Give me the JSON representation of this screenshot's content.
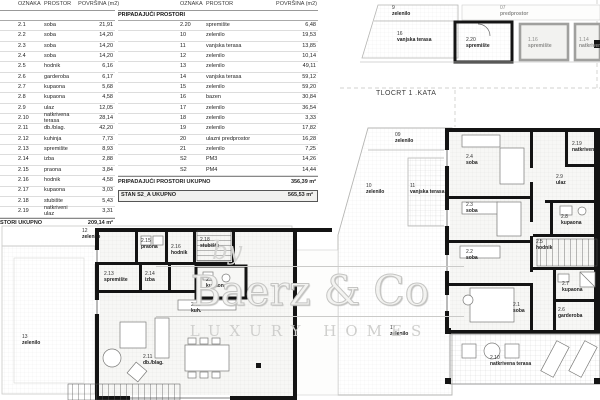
{
  "tables": {
    "headers": {
      "oznaka": "OZNAKA",
      "prostor": "PROSTOR",
      "povrsina": "POVRŠINA (m2)"
    },
    "left": {
      "section": "TORI",
      "rows": [
        {
          "o": "2.1",
          "p": "soba",
          "a": "21,91"
        },
        {
          "o": "2.2",
          "p": "soba",
          "a": "14,20"
        },
        {
          "o": "2.3",
          "p": "soba",
          "a": "14,20"
        },
        {
          "o": "2.4",
          "p": "soba",
          "a": "14,20"
        },
        {
          "o": "2.5",
          "p": "hodnik",
          "a": "6,16"
        },
        {
          "o": "2.6",
          "p": "garderoba",
          "a": "6,17"
        },
        {
          "o": "2.7",
          "p": "kupaona",
          "a": "5,68"
        },
        {
          "o": "2.8",
          "p": "kupaona",
          "a": "4,58"
        },
        {
          "o": "2.9",
          "p": "ulaz",
          "a": "12,05"
        },
        {
          "o": "2.10",
          "p": "natkrivena terasa",
          "a": "28,14"
        },
        {
          "o": "2.11",
          "p": "db./blag.",
          "a": "42,20"
        },
        {
          "o": "2.12",
          "p": "kuhinja",
          "a": "7,73"
        },
        {
          "o": "2.13",
          "p": "spremište",
          "a": "8,93"
        },
        {
          "o": "2.14",
          "p": "izba",
          "a": "2,88"
        },
        {
          "o": "2.15",
          "p": "praona",
          "a": "3,84"
        },
        {
          "o": "2.16",
          "p": "hodnik",
          "a": "4,58"
        },
        {
          "o": "2.17",
          "p": "kupaona",
          "a": "3,03"
        },
        {
          "o": "2.18",
          "p": "stubište",
          "a": "5,43"
        },
        {
          "o": "2.19",
          "p": "natkriveni ulaz",
          "a": "3,31"
        }
      ],
      "footer": {
        "label": "STORI UKUPNO",
        "value": "209,14 m²"
      }
    },
    "right": {
      "section": "PRIPADAJUĆI PROSTORI",
      "rows": [
        {
          "o": "2.20",
          "p": "spremište",
          "a": "6,48"
        },
        {
          "o": "10",
          "p": "zelenilo",
          "a": "19,53"
        },
        {
          "o": "11",
          "p": "vanjska terasa",
          "a": "13,85"
        },
        {
          "o": "12",
          "p": "zelenilo",
          "a": "10,14"
        },
        {
          "o": "13",
          "p": "zelenilo",
          "a": "49,11"
        },
        {
          "o": "14",
          "p": "vanjska terasa",
          "a": "59,12"
        },
        {
          "o": "15",
          "p": "zelenilo",
          "a": "59,20"
        },
        {
          "o": "16",
          "p": "bazen",
          "a": "30,84"
        },
        {
          "o": "17",
          "p": "zelenilo",
          "a": "36,54"
        },
        {
          "o": "18",
          "p": "zelenilo",
          "a": "3,33"
        },
        {
          "o": "19",
          "p": "zelenilo",
          "a": "17,82"
        },
        {
          "o": "20",
          "p": "ulazni predprostor",
          "a": "16,28"
        },
        {
          "o": "21",
          "p": "zelenilo",
          "a": "7,25"
        },
        {
          "o": "S2",
          "p": "PM3",
          "a": "14,26"
        },
        {
          "o": "S2",
          "p": "PM4",
          "a": "14,44"
        }
      ],
      "footer": {
        "label": "PRIPADAJUĆI PROSTORI UKUPNO",
        "value": "356,39 m²"
      },
      "total": {
        "label": "STAN S2_A UKUPNO",
        "value": "565,53 m²"
      }
    }
  },
  "plan": {
    "title": "TLOCRT 1 .KATA",
    "right_rooms": [
      {
        "id": "2.4",
        "name": "soba"
      },
      {
        "id": "2.3",
        "name": "soba"
      },
      {
        "id": "2.2",
        "name": "soba"
      },
      {
        "id": "2.1",
        "name": "soba"
      },
      {
        "id": "2.5",
        "name": "hodnik"
      },
      {
        "id": "2.6",
        "name": "garderoba"
      },
      {
        "id": "2.7",
        "name": "kupaona"
      },
      {
        "id": "2.8",
        "name": "kupaona"
      },
      {
        "id": "2.9",
        "name": "ulaz"
      },
      {
        "id": "2.19",
        "name": "natkriveni"
      },
      {
        "id": "2.10",
        "name": "natkrivena terasa"
      }
    ],
    "right_outdoor": [
      {
        "id": "09",
        "name": "zelenilo"
      },
      {
        "id": "10",
        "name": "zelenilo"
      },
      {
        "id": "11",
        "name": "vanjska terasa"
      },
      {
        "id": "17",
        "name": "zelenilo"
      }
    ],
    "top_fragment": [
      {
        "id": "9",
        "name": "zelenilo"
      },
      {
        "id": "07",
        "name": "predprostor"
      },
      {
        "id": "16",
        "name": "vanjska terasa"
      },
      {
        "id": "2.20",
        "name": "spremište"
      },
      {
        "id": "1.16",
        "name": "spremište"
      },
      {
        "id": "1.14",
        "name": "natkriveni"
      }
    ],
    "left_rooms": [
      {
        "id": "2.15",
        "name": "praona"
      },
      {
        "id": "2.16",
        "name": "hodnik"
      },
      {
        "id": "2.18",
        "name": "stubište"
      },
      {
        "id": "2.13",
        "name": "spremište"
      },
      {
        "id": "2.14",
        "name": "izba"
      },
      {
        "id": "2.17",
        "name": "kupaona"
      },
      {
        "id": "2.12",
        "name": "kuh."
      },
      {
        "id": "2.11",
        "name": "db./blag."
      }
    ],
    "left_outdoor": [
      {
        "id": "12",
        "name": "zelenilo"
      },
      {
        "id": "13",
        "name": "zelenilo"
      }
    ]
  },
  "watermark": {
    "by": "by",
    "name": "Baerz & Co",
    "tagline": "LUXURY HOMES"
  },
  "colors": {
    "wall": "#141414",
    "room_fill": "#f7f7f5",
    "gray_wall": "#a0a09e",
    "accent_line": "#cccccc"
  }
}
